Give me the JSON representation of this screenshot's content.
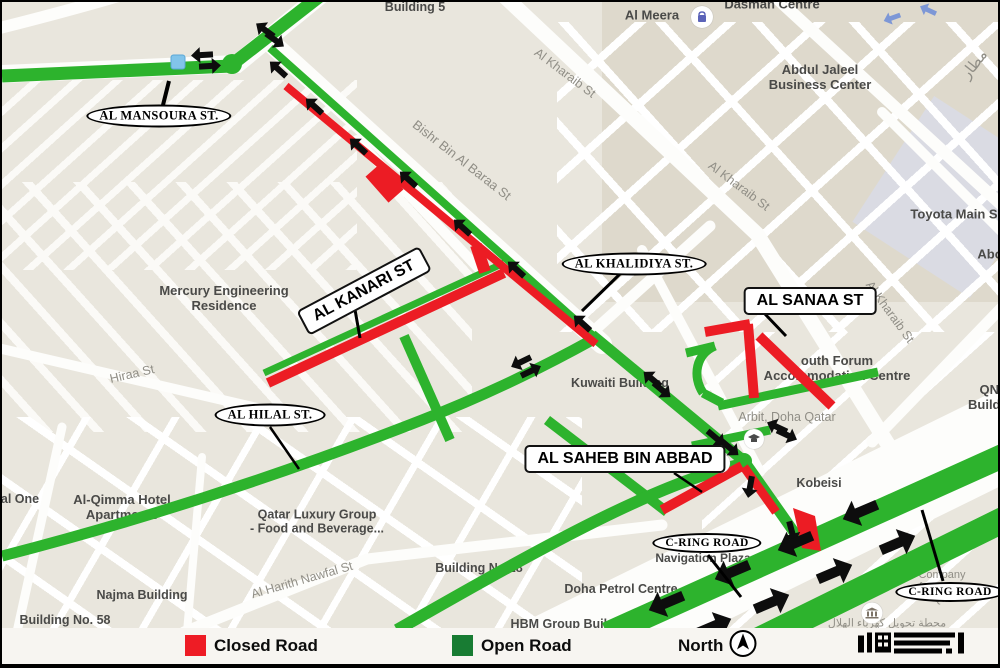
{
  "colors": {
    "open-road": "#2db32d",
    "closed-road": "#ec1c24",
    "legend-open": "#187c33",
    "legend-closed": "#ee1c25",
    "arrow": "#0d0d0d",
    "blue-arrow": "#7d97d6"
  },
  "legend": {
    "closed": "Closed Road",
    "open": "Open Road",
    "north": "North"
  },
  "callouts": {
    "mansoura": "AL MANSOURA ST.",
    "kanari": "AL KANARI ST",
    "khalidiya": "AL KHALIDIYA ST.",
    "sanaa": "AL SANAA ST",
    "hilal": "AL HILAL ST.",
    "saheb": "AL SAHEB BIN ABBAD",
    "cring1": "C-RING ROAD",
    "cring2": "C-RING ROAD"
  },
  "labels": {
    "building_5": "Building 5",
    "dasman": "Dasman Centre",
    "al_meera": "Al Meera",
    "abdul_jaleel": "Abdul Jaleel\nBusiness Center",
    "kharaib_1": "Al Kharaib St",
    "kharaib_2": "Al Kharaib St",
    "kharaib_3": "Al Kharaib St",
    "matar": "مطار",
    "toyota": "Toyota Main S",
    "abo": "Abo",
    "mercury": "Mercury Engineering\nResidence",
    "bishr": "Bishr Bin Al Baraa St",
    "hiraa": "Hiraa St",
    "kuwaiti": "Kuwaiti Building",
    "forum": "outh Forum\nAccommodation Centre",
    "arbit": "Arbit, Doha Qatar",
    "kobeisi": "Kobeisi",
    "qnb": "QNB\nBuilding",
    "al_one": "al One",
    "qimma": "Al-Qimma Hotel\nApartments",
    "qatar_luxury": "Qatar Luxury Group\n- Food and Beverage...",
    "najma": "Najma Building",
    "building_58": "Building No. 58",
    "harith": "Al Harith Nawfal St",
    "building_28": "Building No 28",
    "doha_petrol": "Doha Petrol Centre",
    "hbm": "HBM Group Building",
    "nav_plaza": "Navigation Plaza",
    "company": "Company\nformation Q...",
    "arabic_power": "محطة تحويل كهرباء الهلال"
  }
}
